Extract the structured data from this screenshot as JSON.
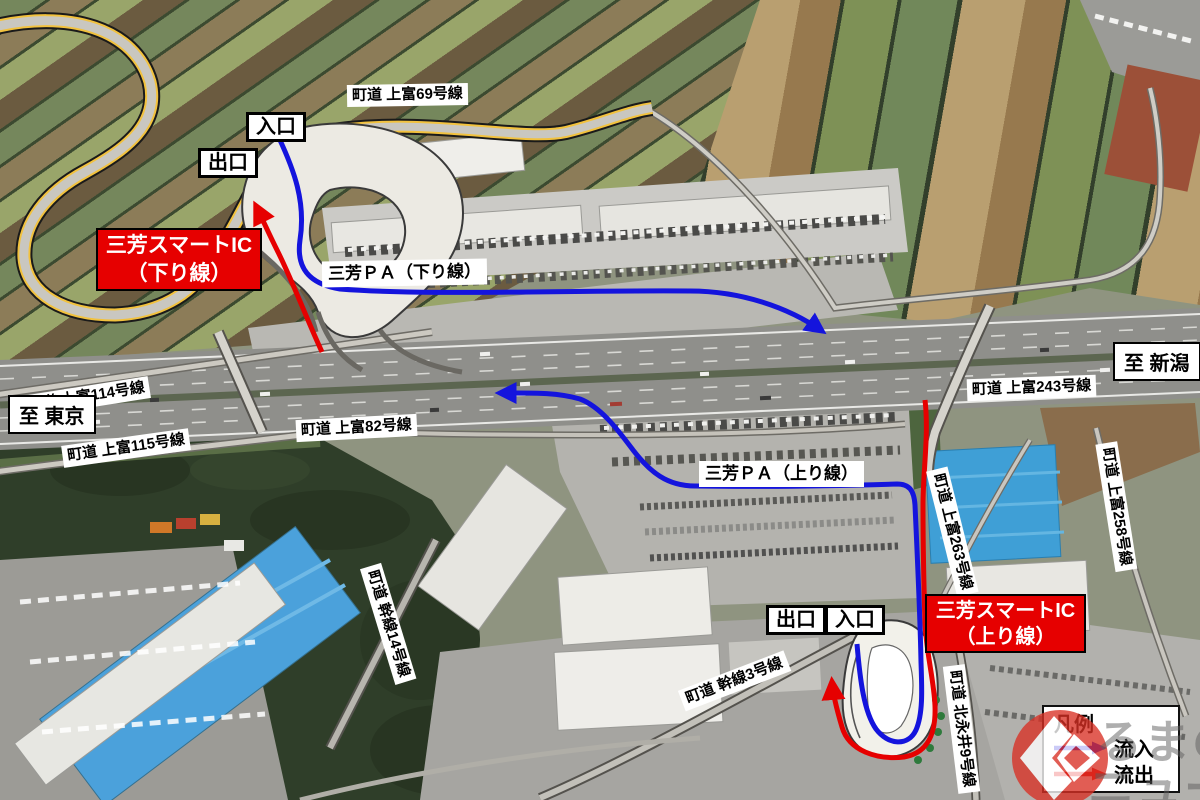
{
  "labels": {
    "road_69": "町道 上富69号線",
    "road_114": "町道 上富114号線",
    "road_115": "町道 上富115号線",
    "road_82": "町道 上富82号線",
    "road_243": "町道 上富243号線",
    "road_258": "町道 上富258号線",
    "road_263": "町道 上富263号線",
    "road_kansen14": "町道 幹線14号線",
    "road_kansen3": "町道 幹線3号線",
    "road_kitanagai9": "町道 北永井9号線",
    "dest_tokyo": "至 東京",
    "dest_niigata": "至 新潟",
    "pa_down": "三芳ＰＡ（下り線）",
    "pa_up": "三芳ＰＡ（上り線）",
    "ic_down_l1": "三芳スマートIC",
    "ic_down_l2": "（下り線）",
    "ic_up_l1": "三芳スマートIC",
    "ic_up_l2": "（上り線）",
    "entrance_down": "入口",
    "exit_down": "出口",
    "entrance_up": "入口",
    "exit_up": "出口"
  },
  "legend": {
    "title": "凡例",
    "inflow_label": "流入",
    "outflow_label": "流出",
    "inflow_color": "#1414dd",
    "outflow_color": "#e60000"
  },
  "colors": {
    "ic_box_red": "#e60000",
    "local_road_yellow": "#f2c23e"
  },
  "watermark": {
    "line1": "るまの",
    "line2": "ニュース"
  }
}
